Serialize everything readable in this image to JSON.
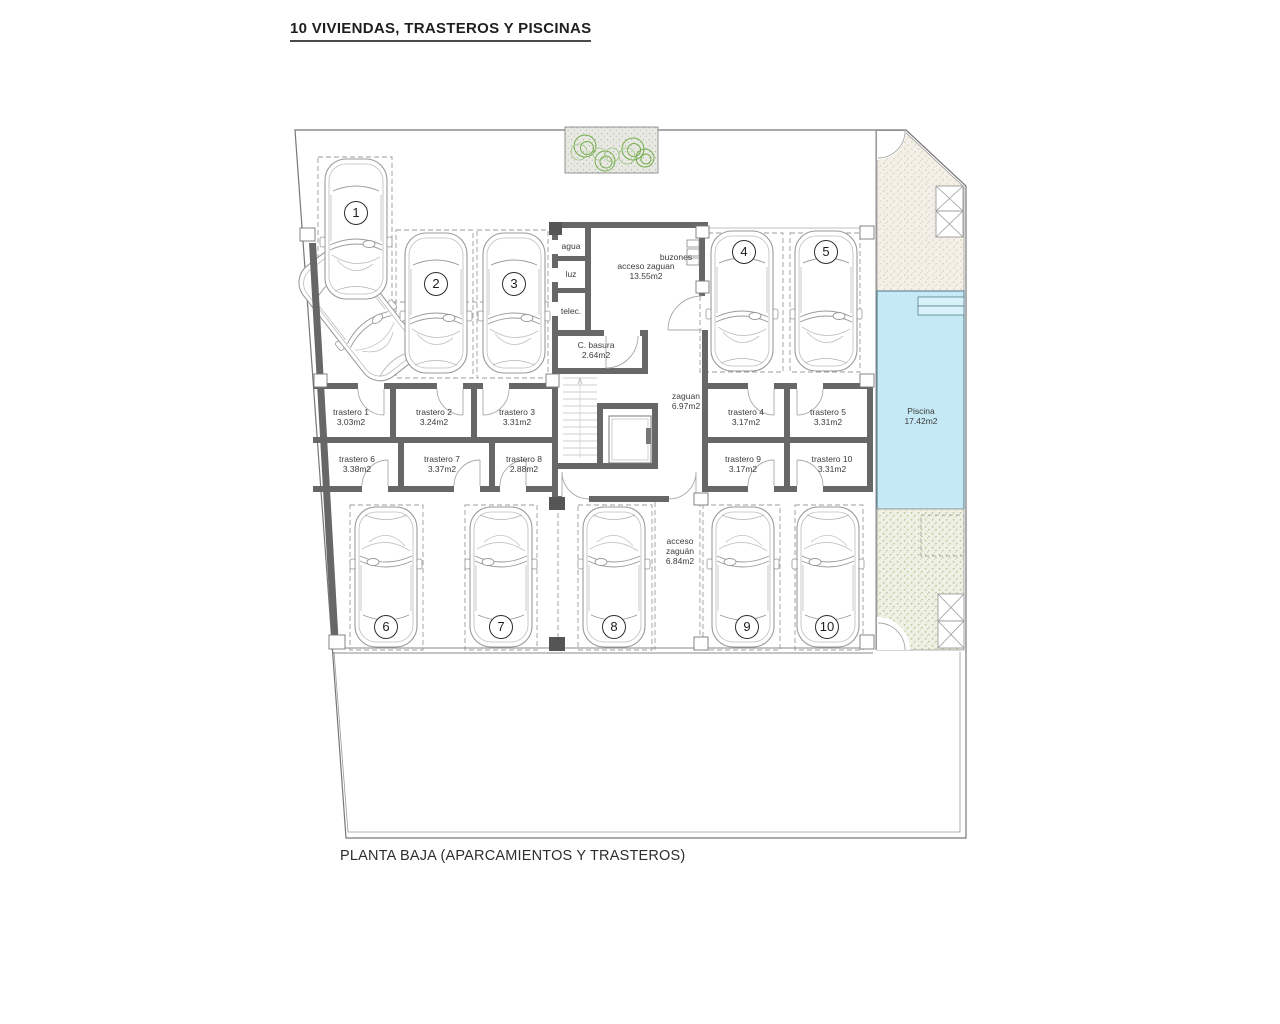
{
  "title": "10 VIVIENDAS, TRASTEROS Y PISCINAS",
  "caption": "PLANTA BAJA (APARCAMIENTOS Y TRASTEROS)",
  "colors": {
    "wall": "#676767",
    "line": "#8a8a8a",
    "pool_fill": "#c5e9f5",
    "pool_edge": "#55808e",
    "plant_green": "#74ae4c",
    "garden_green_dot": "#b6ca99",
    "garden_beige_dot": "#d9cbbc"
  },
  "plan": {
    "utilities": {
      "agua": "agua",
      "luz": "luz",
      "telec": "telec.",
      "buzones": "buzones"
    },
    "rooms": {
      "acceso_zaguan": {
        "name": "acceso zaguan",
        "area": "13.55m2"
      },
      "c_basura": {
        "name": "C. basura",
        "area": "2.64m2"
      },
      "zaguan": {
        "name": "zaguan",
        "area": "6.97m2"
      },
      "acceso_zaguan_sur": {
        "name": "acceso zaguán",
        "area": "6.84m2"
      },
      "piscina": {
        "name": "Piscina",
        "area": "17.42m2"
      }
    },
    "trasteros": [
      {
        "name": "trastero 1",
        "area": "3.03m2"
      },
      {
        "name": "trastero 2",
        "area": "3.24m2"
      },
      {
        "name": "trastero 3",
        "area": "3.31m2"
      },
      {
        "name": "trastero 4",
        "area": "3.17m2"
      },
      {
        "name": "trastero 5",
        "area": "3.31m2"
      },
      {
        "name": "trastero 6",
        "area": "3.38m2"
      },
      {
        "name": "trastero 7",
        "area": "3.37m2"
      },
      {
        "name": "trastero 8",
        "area": "2.88m2"
      },
      {
        "name": "trastero 9",
        "area": "3.17m2"
      },
      {
        "name": "trastero 10",
        "area": "3.31m2"
      }
    ],
    "parking": [
      "1",
      "2",
      "3",
      "4",
      "5",
      "6",
      "7",
      "8",
      "9",
      "10"
    ]
  }
}
